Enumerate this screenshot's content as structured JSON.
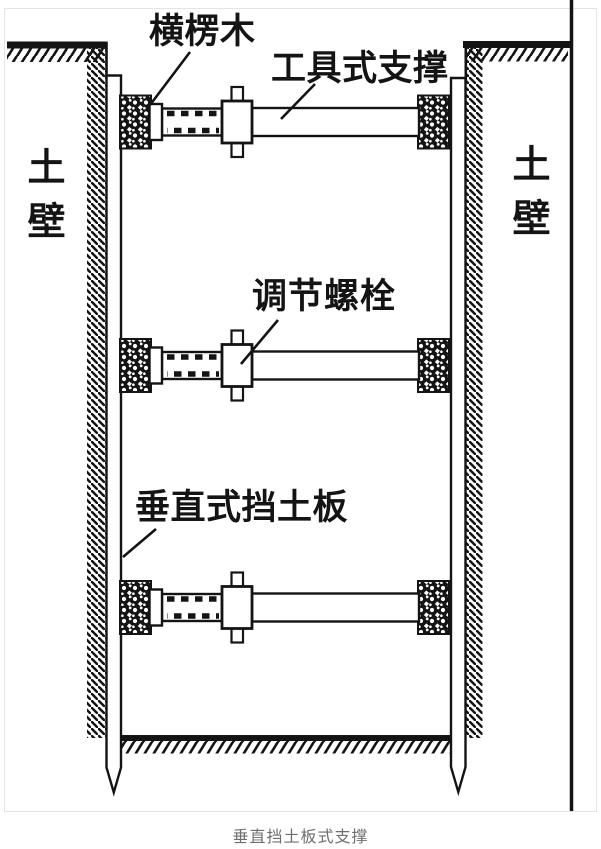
{
  "figure": {
    "labels": {
      "wale_timber": "横楞木",
      "tool_type_strut": "工具式支撑",
      "adjustment_bolt": "调节螺栓",
      "vertical_retaining_board": "垂直式挡土板",
      "soil_wall_left": "土壁",
      "soil_wall_right": "土壁"
    },
    "caption": "垂直挡土板式支撑",
    "colors": {
      "line": "#141414",
      "caption_text": "#6e6e6e",
      "image_border": "#e4e4e4",
      "background": "#ffffff"
    }
  }
}
